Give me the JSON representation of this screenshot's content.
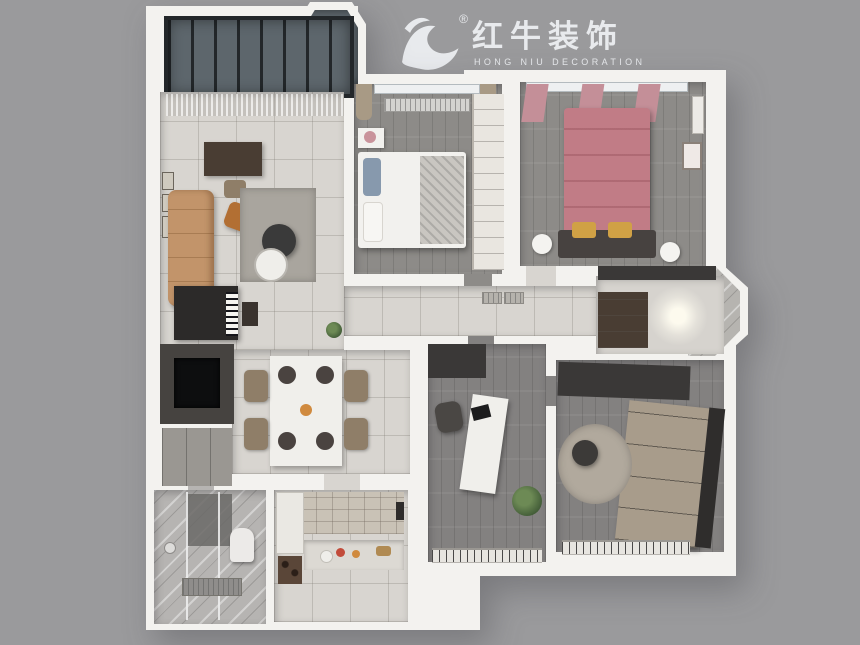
{
  "page": {
    "background": "#9a9a9c"
  },
  "logo": {
    "brand_cn": "红牛装饰",
    "brand_en": "HONG NIU DECORATION",
    "registered": "®",
    "color": "#e8eaed"
  },
  "scene": {
    "type": "3d-floorplan-render",
    "rooms": [
      "balcony",
      "living-room",
      "dining-area",
      "hallway",
      "bedroom-2",
      "master-bedroom",
      "entry-hall",
      "study",
      "cloakroom-bedroom-3",
      "bathroom",
      "kitchen"
    ]
  },
  "palette": {
    "page_bg": "#9a9a9c",
    "wall": "#f3f2ef",
    "tile": "#d8d5d0",
    "glossy": "#d6d3ce",
    "wood": "#8d8b88",
    "wood_dark": "#838180",
    "glass": "#5d666c",
    "bay_glass": "#b6b4b0",
    "sofa": "#c2946a",
    "accent_chair": "#b26f33",
    "rug": "#a9a59e",
    "rug_round": "#b1a99d",
    "bed_white": "#f2f1ee",
    "blanket": "#c9c6c1",
    "pillow_blue": "#8799ad",
    "bed_pink": "#c17c86",
    "headboard": "#474240",
    "pillow_yellow": "#d0a145",
    "curtain_pink": "#c48f98",
    "curtain_tan": "#a89a85",
    "dark_cabinet": "#3a3837",
    "brown_cabinet": "#493d33",
    "wardrobe_tan": "#a89c8b",
    "wardrobe_side": "#2f2d2c",
    "wardrobe_white": "#e9e6e0",
    "kitchen_tile": "#c9c2b6",
    "white_cabinet": "#eae8e3",
    "wine_rack": "#5a4638",
    "counter": "#dcd9d3",
    "marble": "#b6b4b2",
    "shower_wall": "#6a6866",
    "toilet": "#eceae8",
    "tv_wall": "#464340",
    "tv_screen": "#0d0e0f",
    "piano": "#2c2a29",
    "gray_cabinet": "#9a9792",
    "table_white": "#f0efeb",
    "chair_brown": "#8f7e68",
    "placemat": "#4a4340",
    "radiator": "#d4d3d0",
    "window_white": "#eef0f1",
    "railing_bg": "#e7e5e0",
    "vent": "#b5b2ac",
    "lamp_white": "#f4f3f0",
    "food_red": "#c24b3a",
    "food_orange": "#d08a3e",
    "drain": "#8f8d8b"
  }
}
